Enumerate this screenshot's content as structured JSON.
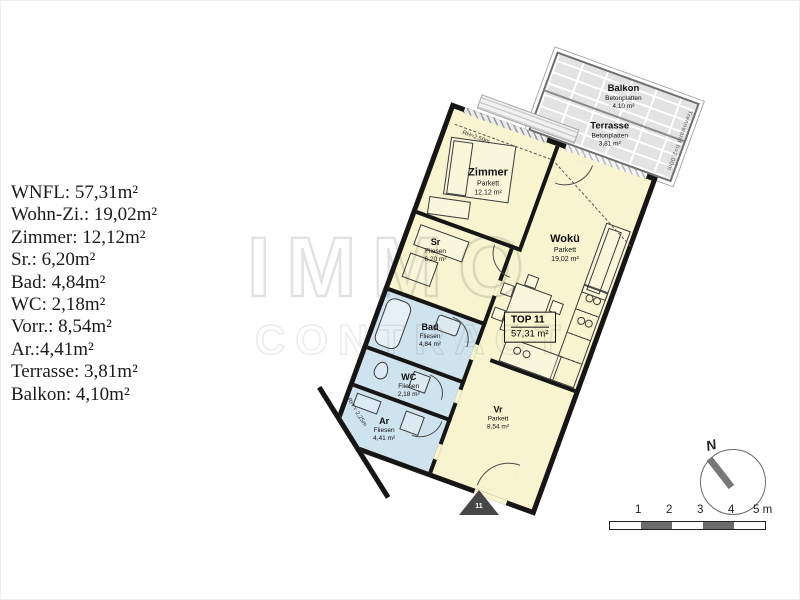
{
  "area_list": {
    "items": [
      "WNFL: 57,31m²",
      "Wohn-Zi.: 19,02m²",
      "Zimmer: 12,12m²",
      "Sr.: 6,20m²",
      "Bad: 4,84m²",
      "WC: 2,18m²",
      "Vorr.: 8,54m²",
      "Ar.:4,41m²",
      "Terrasse: 3,81m²",
      "Balkon: 4,10m²"
    ]
  },
  "watermark": {
    "line1": "IMMO",
    "line2": "CONTRACT"
  },
  "floorplan": {
    "unit_label": {
      "title": "TOP 11",
      "area": "57,31 m²"
    },
    "rooms": [
      {
        "name": "Zimmer",
        "floor": "Parkett",
        "area": "12,12 m²"
      },
      {
        "name": "Wokü",
        "floor": "Parkett",
        "area": "19,02 m²"
      },
      {
        "name": "Sr",
        "floor": "Fliesen",
        "area": "6,20 m²"
      },
      {
        "name": "Bad",
        "floor": "Fliesen",
        "area": "4,84 m²"
      },
      {
        "name": "WC",
        "floor": "Fliesen",
        "area": "2,18 m²"
      },
      {
        "name": "Vr",
        "floor": "Parkett",
        "area": "8,54 m²"
      },
      {
        "name": "Ar",
        "floor": "Fliesen",
        "area": "4,41 m²"
      }
    ],
    "outdoor": [
      {
        "name": "Balkon",
        "floor": "Betonplatten",
        "area": "4,10 m²"
      },
      {
        "name": "Terrasse",
        "floor": "Betonplatten",
        "area": "3,81 m²"
      }
    ],
    "annotations": {
      "partition": "Trennwand h=2,00m",
      "zimmer_height": "RH≈2,50m",
      "ar_height": "RH = 2,25m",
      "entrance_marker": "11"
    }
  },
  "compass": {
    "label": "N"
  },
  "scale_bar": {
    "ticks": [
      "1",
      "2",
      "3",
      "4"
    ],
    "end_label": "5 m"
  },
  "colors": {
    "room_fill": "#f7f4cf",
    "wet_room_fill": "#cfe3ef",
    "wall": "#161616",
    "terrace_fill": "#e3e3e3",
    "background": "#ffffff"
  }
}
